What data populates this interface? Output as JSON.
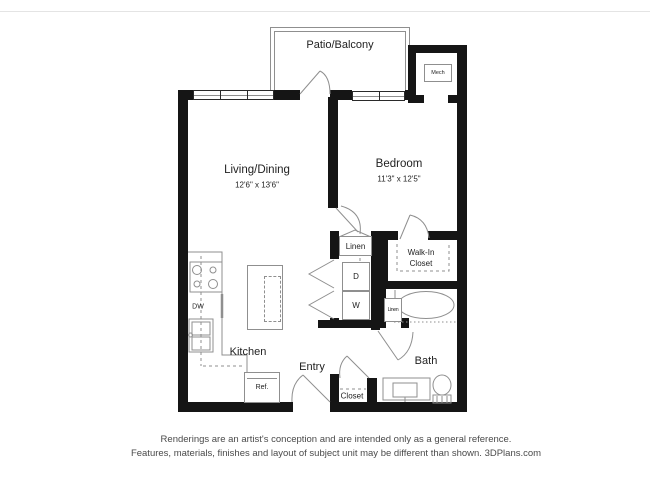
{
  "plan": {
    "patio": "Patio/Balcony",
    "living": "Living/Dining",
    "living_dims": "12'6\" x 13'6\"",
    "bedroom": "Bedroom",
    "bedroom_dims": "11'3\" x 12'5\"",
    "kitchen": "Kitchen",
    "entry": "Entry",
    "bath": "Bath",
    "walk_in_closet": "Walk-In Closet",
    "linen_hall": "Linen",
    "linen_bath": "Linen",
    "closet": "Closet",
    "mech": "Mech",
    "dryer": "D",
    "washer": "W",
    "dishwasher": "DW",
    "refrigerator": "Ref."
  },
  "footer": {
    "line1": "Renderings are an artist's conception and are intended only as a general reference.",
    "line2": "Features, materials, finishes and layout of subject unit may be different than shown. 3DPlans.com"
  },
  "colors": {
    "wall": "#151515",
    "line": "#8f8f8f",
    "text": "#222222",
    "footer_text": "#4a4a4a"
  }
}
